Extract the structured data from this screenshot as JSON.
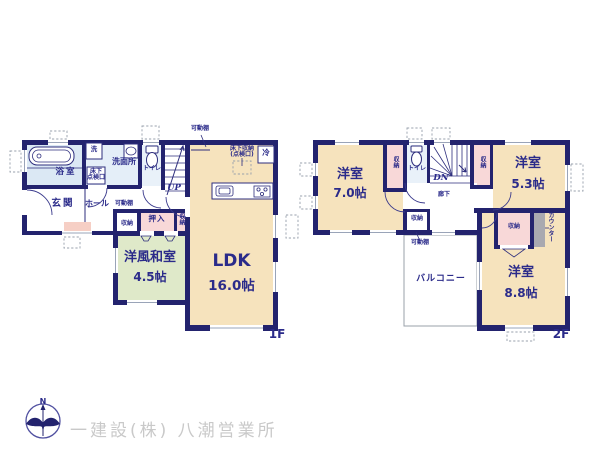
{
  "floor1": {
    "floor_label": "1F",
    "ldk": {
      "name": "LDK",
      "size": "16.0帖"
    },
    "washitsu": {
      "name": "洋風和室",
      "size": "4.5帖"
    },
    "bath": "浴室",
    "washroom": "洗面所",
    "washer": "洗",
    "toilet": "トイレ",
    "underfloor_hatch_line1": "床下",
    "underfloor_hatch_line2": "点検口",
    "genkan": "玄関",
    "hall": "ホール",
    "stairs_up": "UP",
    "oshiire": "押入",
    "closet_vertical": "収納",
    "closet_small": "収納",
    "movable_shelf_hall": "可動棚",
    "movable_shelf_ldk": "可動棚",
    "underfloor_storage_line1": "床下収納",
    "underfloor_storage_line2": "(点検口)",
    "fridge": "冷"
  },
  "floor2": {
    "floor_label": "2F",
    "room7": {
      "name": "洋室",
      "size": "7.0帖"
    },
    "room53": {
      "name": "洋室",
      "size": "5.3帖"
    },
    "room88": {
      "name": "洋室",
      "size": "8.8帖"
    },
    "toilet": "トイレ",
    "stairs_down": "DN",
    "corridor": "廊下",
    "balcony": "バルコニー",
    "closet_room7": "収納",
    "closet_room53": "収納",
    "closet_corridor": "収納",
    "closet_room88": "収納",
    "counter": "カウンター",
    "movable_shelf": "可動棚"
  },
  "footer": {
    "company": "一建設(株) 八潮営業所",
    "compass_north": "N"
  },
  "colors": {
    "wall": "#23236e",
    "room_beige": "#f6e3bd",
    "room_green": "#dfe9c9",
    "room_pink": "#f8d8d8",
    "room_blue": "#e2ecf7",
    "counter_gray": "#a9a9b0",
    "footer_text": "#c9c9c9",
    "label_navy": "#2b2b8a"
  }
}
